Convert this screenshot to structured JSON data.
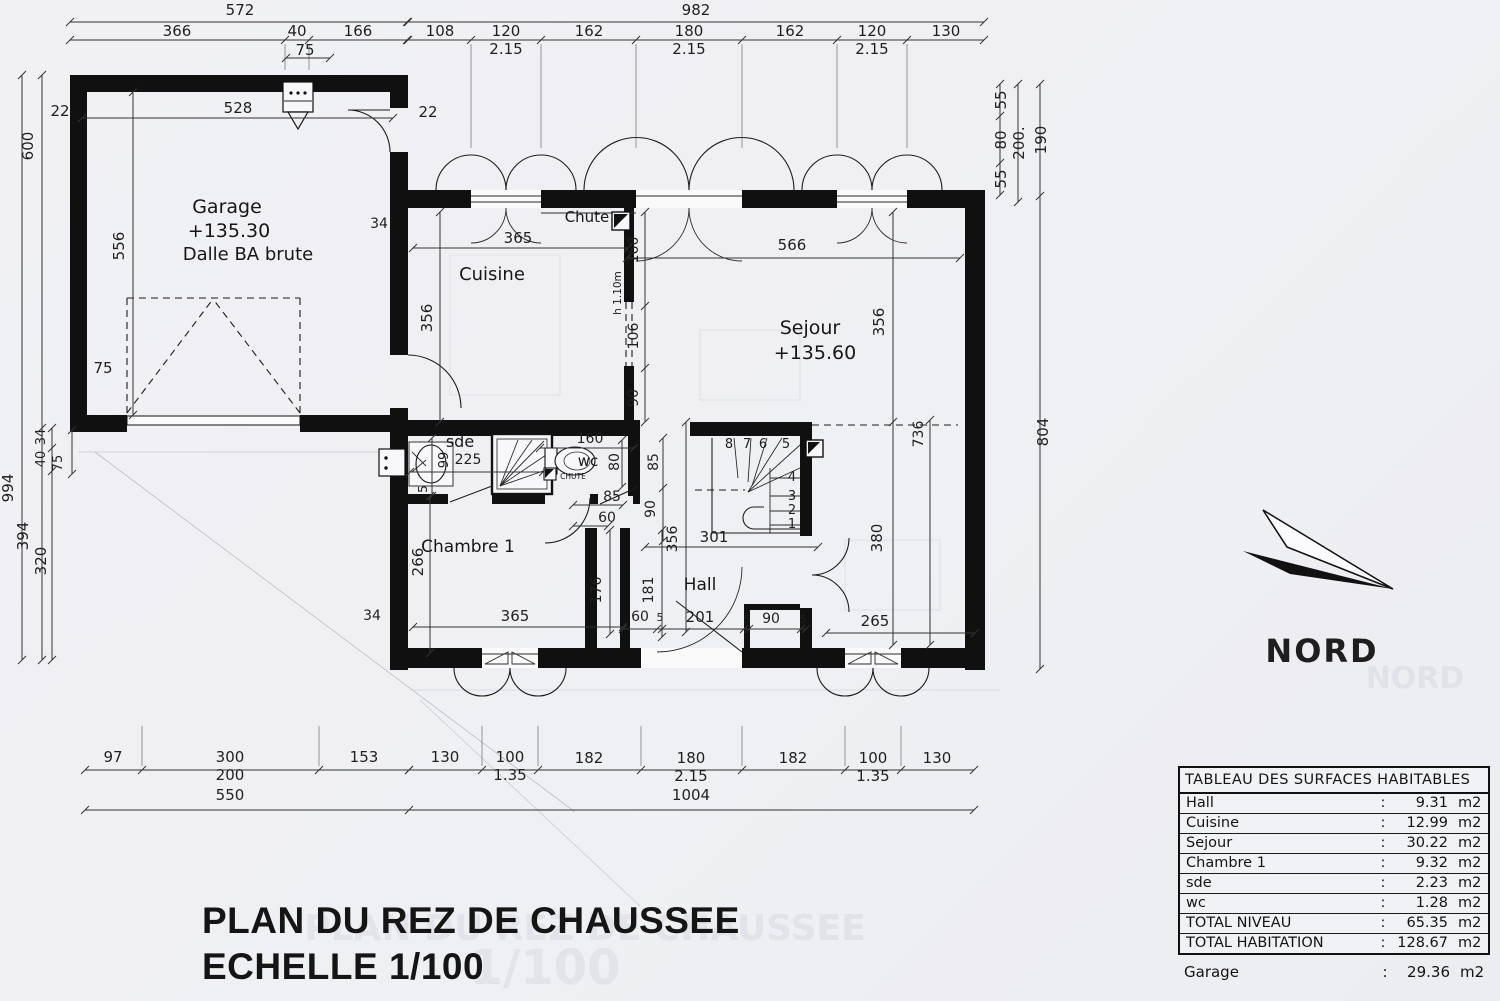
{
  "title": {
    "line1": "PLAN DU REZ DE CHAUSSEE",
    "line2": "ECHELLE 1/100",
    "ghost_scale": "1/100"
  },
  "north": {
    "label": "NORD"
  },
  "rooms": {
    "garage": {
      "name": "Garage",
      "level": "+135.30",
      "slab": "Dalle BA brute"
    },
    "cuisine": {
      "name": "Cuisine"
    },
    "sejour": {
      "name": "Sejour",
      "level": "+135.60"
    },
    "chambre1": {
      "name": "Chambre 1"
    },
    "hall": {
      "name": "Hall"
    },
    "sde": {
      "name": "sde"
    },
    "wc": {
      "name": "wc"
    },
    "chute": {
      "label": "Chute"
    },
    "chute_small": {
      "label": "CHUTE"
    },
    "counter": {
      "label": "h 1.10m"
    }
  },
  "surface_table": {
    "title": "TABLEAU DES SURFACES HABITABLES",
    "colon": ":",
    "rows": [
      {
        "label": "Hall",
        "value": "9.31",
        "unit": "m2"
      },
      {
        "label": "Cuisine",
        "value": "12.99",
        "unit": "m2"
      },
      {
        "label": "Sejour",
        "value": "30.22",
        "unit": "m2"
      },
      {
        "label": "Chambre 1",
        "value": "9.32",
        "unit": "m2"
      },
      {
        "label": "sde",
        "value": "2.23",
        "unit": "m2"
      },
      {
        "label": "wc",
        "value": "1.28",
        "unit": "m2"
      },
      {
        "label": "TOTAL NIVEAU",
        "value": "65.35",
        "unit": "m2"
      },
      {
        "label": "TOTAL HABITATION",
        "value": "128.67",
        "unit": "m2"
      }
    ],
    "garage_row": {
      "label": "Garage",
      "value": "29.36",
      "unit": "m2"
    }
  },
  "dim_labels": [
    {
      "t": "572",
      "x": 240,
      "y": 15
    },
    {
      "t": "366",
      "x": 177,
      "y": 36
    },
    {
      "t": "40",
      "x": 297,
      "y": 36
    },
    {
      "t": "166",
      "x": 358,
      "y": 36
    },
    {
      "t": "75",
      "x": 305,
      "y": 55
    },
    {
      "t": "22",
      "x": 60,
      "y": 116
    },
    {
      "t": "528",
      "x": 238,
      "y": 113
    },
    {
      "t": "22",
      "x": 428,
      "y": 117
    },
    {
      "t": "982",
      "x": 696,
      "y": 15
    },
    {
      "t": "108",
      "x": 440,
      "y": 36
    },
    {
      "t": "120",
      "x": 506,
      "y": 36
    },
    {
      "t": "2.15",
      "x": 506,
      "y": 54
    },
    {
      "t": "162",
      "x": 589,
      "y": 36
    },
    {
      "t": "180",
      "x": 689,
      "y": 36
    },
    {
      "t": "2.15",
      "x": 689,
      "y": 54
    },
    {
      "t": "162",
      "x": 790,
      "y": 36
    },
    {
      "t": "120",
      "x": 872,
      "y": 36
    },
    {
      "t": "2.15",
      "x": 872,
      "y": 54
    },
    {
      "t": "130",
      "x": 946,
      "y": 36
    },
    {
      "t": "55",
      "x": 1006,
      "y": 100,
      "r": -90
    },
    {
      "t": "80",
      "x": 1006,
      "y": 140,
      "r": -90
    },
    {
      "t": "200.",
      "x": 1024,
      "y": 143,
      "r": -90
    },
    {
      "t": "55",
      "x": 1006,
      "y": 179,
      "r": -90
    },
    {
      "t": "190",
      "x": 1046,
      "y": 140,
      "r": -90
    },
    {
      "t": "804",
      "x": 1048,
      "y": 432,
      "r": -90
    },
    {
      "t": "600",
      "x": 33,
      "y": 146,
      "r": -90
    },
    {
      "t": "994",
      "x": 13,
      "y": 488,
      "r": -90
    },
    {
      "t": "556",
      "x": 124,
      "y": 246,
      "r": -90
    },
    {
      "t": "75",
      "x": 103,
      "y": 373
    },
    {
      "t": "34",
      "x": 45,
      "y": 437,
      "r": -90,
      "fs": 13
    },
    {
      "t": "40",
      "x": 45,
      "y": 459,
      "r": -90,
      "fs": 13
    },
    {
      "t": "75",
      "x": 62,
      "y": 463,
      "r": -90,
      "fs": 13
    },
    {
      "t": "394",
      "x": 28,
      "y": 536,
      "r": -90
    },
    {
      "t": "320",
      "x": 46,
      "y": 561,
      "r": -90
    },
    {
      "t": "34",
      "x": 379,
      "y": 228,
      "fs": 14
    },
    {
      "t": "34",
      "x": 372,
      "y": 620,
      "fs": 14
    },
    {
      "t": "365",
      "x": 518,
      "y": 243
    },
    {
      "t": "356",
      "x": 432,
      "y": 318,
      "r": -90
    },
    {
      "t": "160",
      "x": 638,
      "y": 250,
      "r": -90,
      "fs": 14
    },
    {
      "t": "106",
      "x": 638,
      "y": 336,
      "r": -90,
      "fs": 14
    },
    {
      "t": "90",
      "x": 638,
      "y": 398,
      "r": -90,
      "fs": 14
    },
    {
      "t": "566",
      "x": 792,
      "y": 250
    },
    {
      "t": "356",
      "x": 884,
      "y": 322,
      "r": -90
    },
    {
      "t": "736",
      "x": 923,
      "y": 434,
      "r": -90,
      "fs": 14
    },
    {
      "t": "380",
      "x": 882,
      "y": 538,
      "r": -90
    },
    {
      "t": "99",
      "x": 448,
      "y": 460,
      "r": -90,
      "fs": 13
    },
    {
      "t": "225",
      "x": 468,
      "y": 464,
      "fs": 14
    },
    {
      "t": "5",
      "x": 427,
      "y": 489,
      "r": -90,
      "fs": 12
    },
    {
      "t": "160",
      "x": 590,
      "y": 443,
      "fs": 14
    },
    {
      "t": "80",
      "x": 619,
      "y": 462,
      "r": -90,
      "fs": 14
    },
    {
      "t": "85",
      "x": 658,
      "y": 462,
      "r": -90,
      "fs": 14
    },
    {
      "t": "85",
      "x": 612,
      "y": 501,
      "fs": 14
    },
    {
      "t": "90",
      "x": 655,
      "y": 509,
      "r": -90,
      "fs": 14
    },
    {
      "t": "60",
      "x": 607,
      "y": 522,
      "fs": 14
    },
    {
      "t": "356",
      "x": 677,
      "y": 539,
      "r": -90,
      "fs": 14
    },
    {
      "t": "301",
      "x": 714,
      "y": 542,
      "fs": 15
    },
    {
      "t": "266",
      "x": 423,
      "y": 562,
      "r": -90
    },
    {
      "t": "176",
      "x": 601,
      "y": 590,
      "r": -90,
      "fs": 14
    },
    {
      "t": "181",
      "x": 653,
      "y": 590,
      "r": -90,
      "fs": 14
    },
    {
      "t": "365",
      "x": 515,
      "y": 621
    },
    {
      "t": "60",
      "x": 640,
      "y": 621,
      "fs": 14
    },
    {
      "t": "5",
      "x": 660,
      "y": 621,
      "fs": 11
    },
    {
      "t": "201",
      "x": 700,
      "y": 622
    },
    {
      "t": "5",
      "x": 747,
      "y": 623,
      "fs": 11
    },
    {
      "t": "90",
      "x": 771,
      "y": 623,
      "fs": 14
    },
    {
      "t": "5",
      "x": 803,
      "y": 623,
      "fs": 11
    },
    {
      "t": "265",
      "x": 875,
      "y": 626
    },
    {
      "t": "8",
      "x": 729,
      "y": 448,
      "fs": 13
    },
    {
      "t": "7",
      "x": 747,
      "y": 448,
      "fs": 13
    },
    {
      "t": "6",
      "x": 763,
      "y": 448,
      "fs": 13
    },
    {
      "t": "5",
      "x": 786,
      "y": 448,
      "fs": 13
    },
    {
      "t": "4",
      "x": 792,
      "y": 481,
      "fs": 13
    },
    {
      "t": "3",
      "x": 792,
      "y": 500,
      "fs": 13
    },
    {
      "t": "2",
      "x": 792,
      "y": 514,
      "fs": 13
    },
    {
      "t": "1",
      "x": 792,
      "y": 528,
      "fs": 13
    },
    {
      "t": "97",
      "x": 113,
      "y": 762
    },
    {
      "t": "300",
      "x": 230,
      "y": 762
    },
    {
      "t": "200",
      "x": 230,
      "y": 780
    },
    {
      "t": "153",
      "x": 364,
      "y": 762
    },
    {
      "t": "130",
      "x": 445,
      "y": 762
    },
    {
      "t": "100",
      "x": 510,
      "y": 762
    },
    {
      "t": "1.35",
      "x": 510,
      "y": 780
    },
    {
      "t": "182",
      "x": 589,
      "y": 763
    },
    {
      "t": "180",
      "x": 691,
      "y": 763
    },
    {
      "t": "2.15",
      "x": 691,
      "y": 781
    },
    {
      "t": "182",
      "x": 793,
      "y": 763
    },
    {
      "t": "100",
      "x": 873,
      "y": 763
    },
    {
      "t": "1.35",
      "x": 873,
      "y": 781
    },
    {
      "t": "130",
      "x": 937,
      "y": 763
    },
    {
      "t": "550",
      "x": 230,
      "y": 800
    },
    {
      "t": "1004",
      "x": 691,
      "y": 800
    }
  ]
}
